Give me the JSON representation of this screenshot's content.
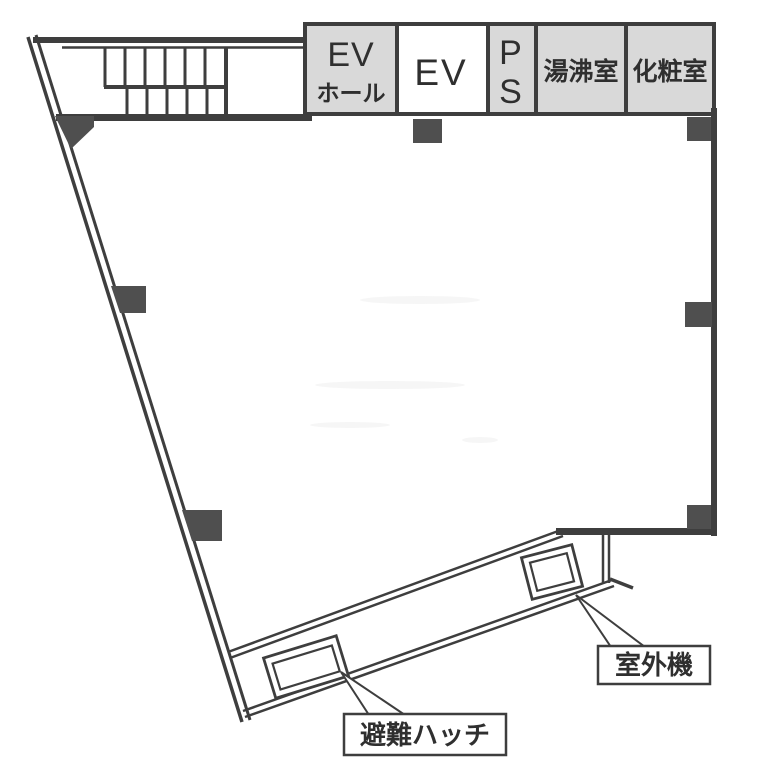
{
  "diagram_type": "floor-plan",
  "rooms": {
    "ev_hall": {
      "line1": "EV",
      "line2": "ホール"
    },
    "elevator": {
      "label": "EV"
    },
    "pipe_space": {
      "line1": "P",
      "line2": "S"
    },
    "hot_water_room": {
      "label": "湯沸室"
    },
    "restroom": {
      "label": "化粧室"
    }
  },
  "callouts": {
    "evacuation_hatch": {
      "label": "避難ハッチ"
    },
    "outdoor_unit": {
      "label": "室外機"
    }
  },
  "colors": {
    "wall": "#3e3e3e",
    "room_fill": "#d9d9d9",
    "elevator_fill": "#ffffff",
    "column_fill": "#4f4f4f",
    "background": "#ffffff",
    "text": "#2f2f2f"
  }
}
